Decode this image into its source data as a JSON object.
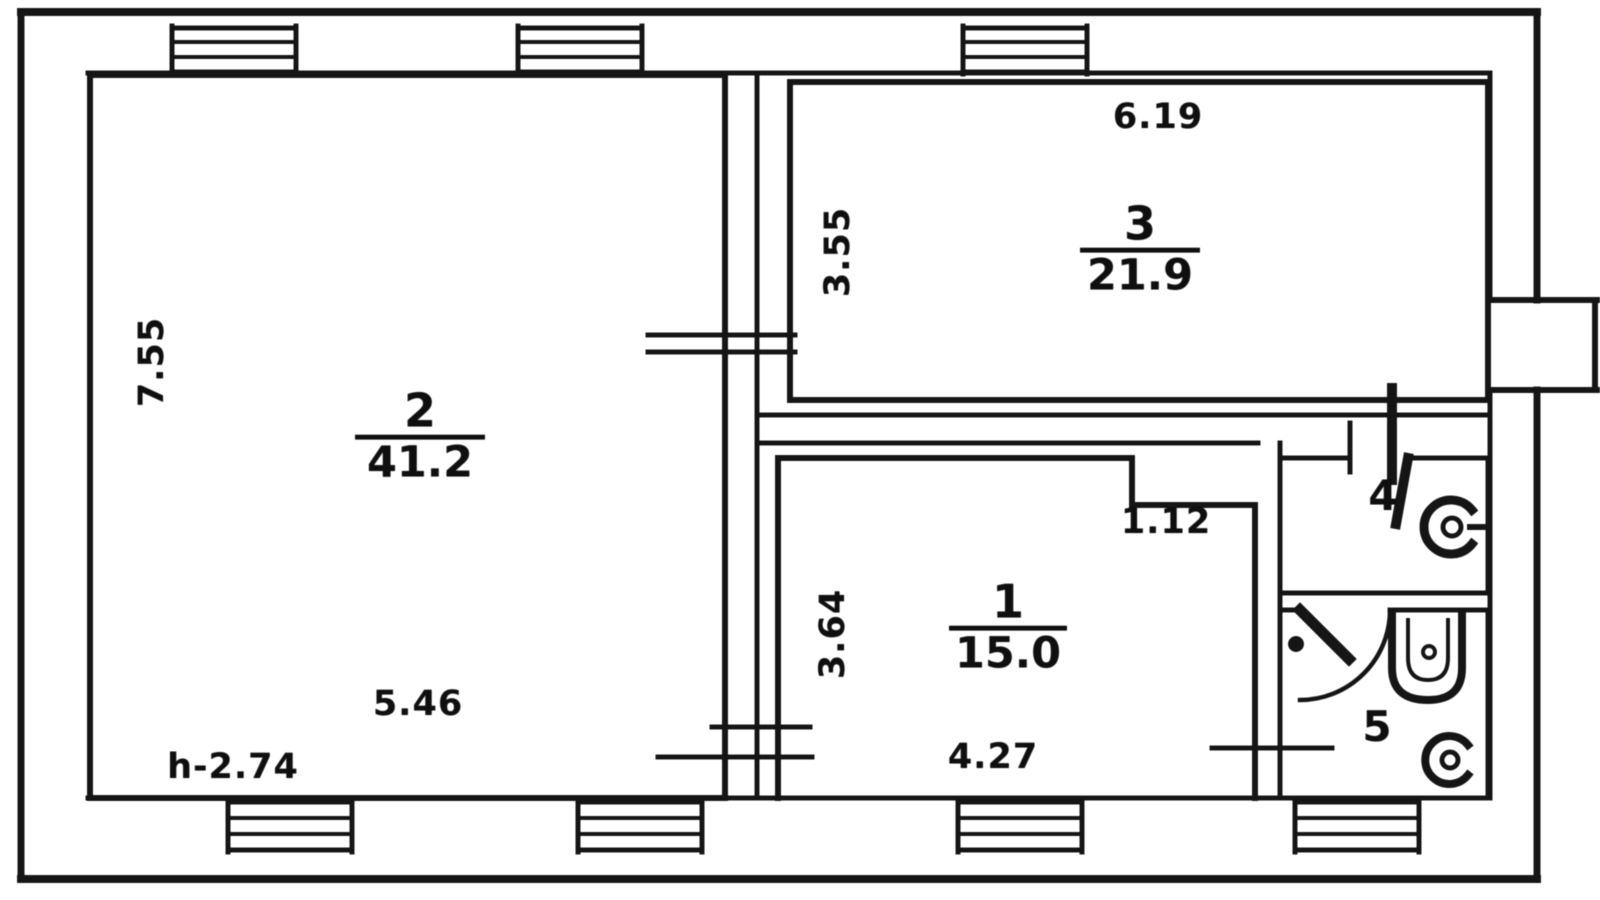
{
  "plan": {
    "rooms": {
      "r1": {
        "number": "1",
        "area": "15.0",
        "width_label": "4.27",
        "height_label": "3.64",
        "notch_label": "1.12"
      },
      "r2": {
        "number": "2",
        "area": "41.2",
        "width_label": "5.46",
        "height_label": "7.55",
        "ceiling_label": "h-2.74"
      },
      "r3": {
        "number": "3",
        "area": "21.9",
        "width_label": "6.19",
        "height_label": "3.55"
      },
      "r4": {
        "number": "4"
      },
      "r5": {
        "number": "5"
      }
    },
    "fixtures": {
      "room4_fixture": "toilet",
      "room5_fixture_top": "sink",
      "room5_fixture_bottom": "toilet",
      "room5_door": "door-swing"
    },
    "colors": {
      "ink": "#1a1a1a",
      "paper": "#ffffff"
    }
  }
}
